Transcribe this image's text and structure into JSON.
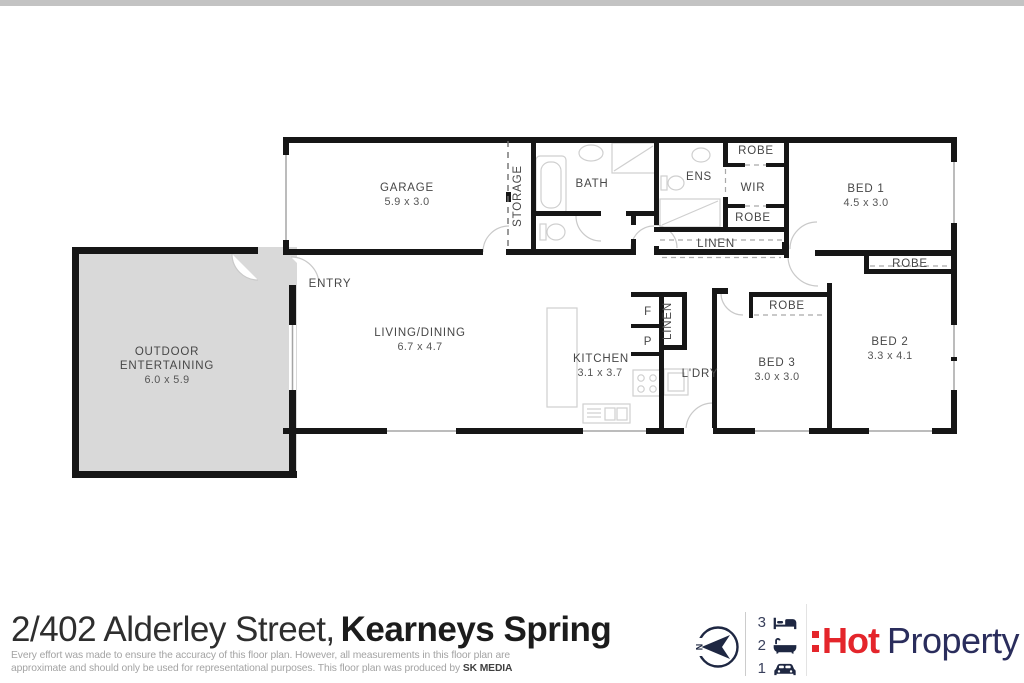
{
  "plan": {
    "garage_name": "GARAGE",
    "garage_dims": "5.9 x 3.0",
    "storage": "STORAGE",
    "bath": "BATH",
    "ens": "ENS",
    "wir": "WIR",
    "robe_wir_top": "ROBE",
    "robe_wir_bottom": "ROBE",
    "linen_hall": "LINEN",
    "bed1_name": "BED 1",
    "bed1_dims": "4.5 x 3.0",
    "entry": "ENTRY",
    "living_name": "LIVING/DINING",
    "living_dims": "6.7 x 4.7",
    "kitchen_name": "KITCHEN",
    "kitchen_dims": "3.1 x 3.7",
    "fridge": "F",
    "pantry": "P",
    "linen_kitchen": "LINEN",
    "laundry": "L'DRY",
    "robe_bed3": "ROBE",
    "bed3_name": "BED 3",
    "bed3_dims": "3.0 x 3.0",
    "robe_bed2": "ROBE",
    "bed2_name": "BED 2",
    "bed2_dims": "3.3 x 4.1",
    "outdoor_line1": "OUTDOOR",
    "outdoor_line2": "ENTERTAINING",
    "outdoor_dims": "6.0 x 5.9"
  },
  "footer": {
    "address_light": "2/402 Alderley Street,",
    "address_bold": "Kearneys Spring",
    "disclaimer_line1": "Every effort was made to ensure the accuracy of this floor plan. However, all measurements in this floor plan are",
    "disclaimer_line2": "approximate and should only be used for representational purposes. This floor plan was produced by",
    "producer": "SK MEDIA",
    "compass": {
      "north": "N"
    },
    "features": [
      {
        "count": "3",
        "icon": "bed-icon"
      },
      {
        "count": "2",
        "icon": "bath-icon"
      },
      {
        "count": "1",
        "icon": "car-icon"
      }
    ],
    "logo": {
      "hot": "Hot",
      "property": "Property"
    },
    "colors": {
      "logo_red": "#e4252b",
      "logo_navy": "#2a2d5c",
      "wall_black": "#161616",
      "outdoor_fill": "#d9d9d9"
    }
  }
}
